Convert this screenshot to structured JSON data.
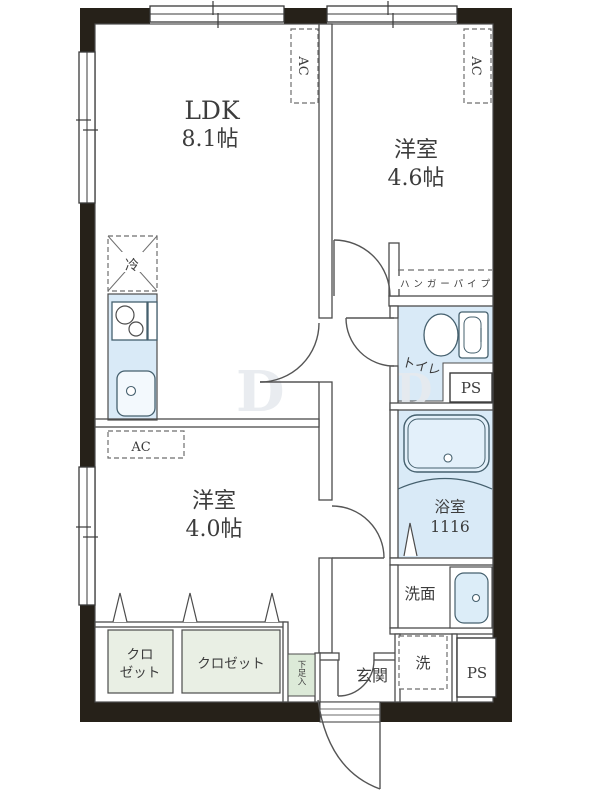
{
  "plan": {
    "rooms": {
      "ldk": {
        "name": "LDK",
        "area": "8.1帖"
      },
      "bedroom1": {
        "name": "洋室",
        "area": "4.6帖"
      },
      "bedroom2": {
        "name": "洋室",
        "area": "4.0帖"
      },
      "toilet": {
        "label": "トイレ"
      },
      "bath": {
        "label": "浴室",
        "size": "1116"
      },
      "washroom": {
        "label": "洗面"
      },
      "entrance": {
        "label": "玄関"
      }
    },
    "fixtures": {
      "ac": "AC",
      "fridge": "冷",
      "hanger_pipe": "ハンガーパイプ",
      "washer_pan": "洗",
      "pipe_space": "PS",
      "closet_small_line1": "クロ",
      "closet_small_line2": "ゼット",
      "closet_large": "クロゼット",
      "shoe_box": "下足入"
    },
    "watermark": {
      "letter1": "D",
      "letter2": "D"
    },
    "colors": {
      "wall": "#262119",
      "water_blue": "#d9eaf7",
      "closet_green": "#e9efe4",
      "shoe_green": "#dcead8",
      "line": "#4c4c4c",
      "text": "#3c3c3c"
    }
  }
}
